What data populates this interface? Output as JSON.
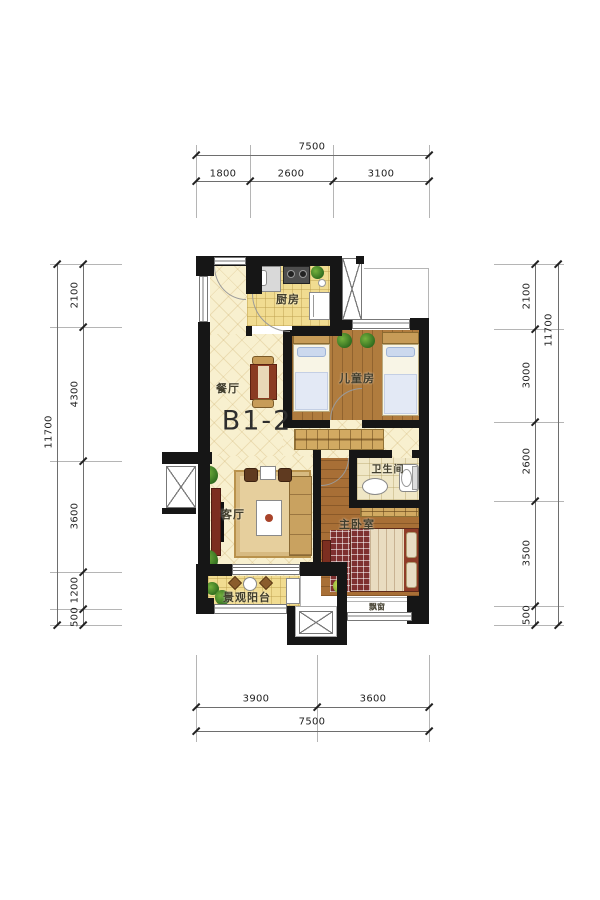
{
  "unit": {
    "label": "B1-2"
  },
  "rooms": {
    "kitchen": "厨房",
    "dining": "餐厅",
    "children": "儿童房",
    "bathroom": "卫生间",
    "living": "客厅",
    "master": "主卧室",
    "balcony": "景观阳台",
    "bay_window": "飘窗"
  },
  "dimensions": {
    "top": {
      "total": "7500",
      "segments": [
        "1800",
        "2600",
        "3100"
      ]
    },
    "bottom": {
      "total": "7500",
      "segments": [
        "3900",
        "3600"
      ]
    },
    "left": {
      "total": "11700",
      "segments": [
        "2100",
        "4300",
        "3600",
        "1200",
        "500"
      ]
    },
    "right": {
      "total": "11700",
      "segments": [
        "2100",
        "3000",
        "2600",
        "3500",
        "500"
      ]
    }
  },
  "palette": {
    "wall": "#161616",
    "floor_cream": "#f8f0cf",
    "floor_kitchen": "#f1dc91",
    "wood_light": "#b07c3e",
    "wood_dark": "#a86f36",
    "bed_red": "#8f3c28",
    "plant_green": "#3f7d2c",
    "dim_text": "#222222"
  }
}
